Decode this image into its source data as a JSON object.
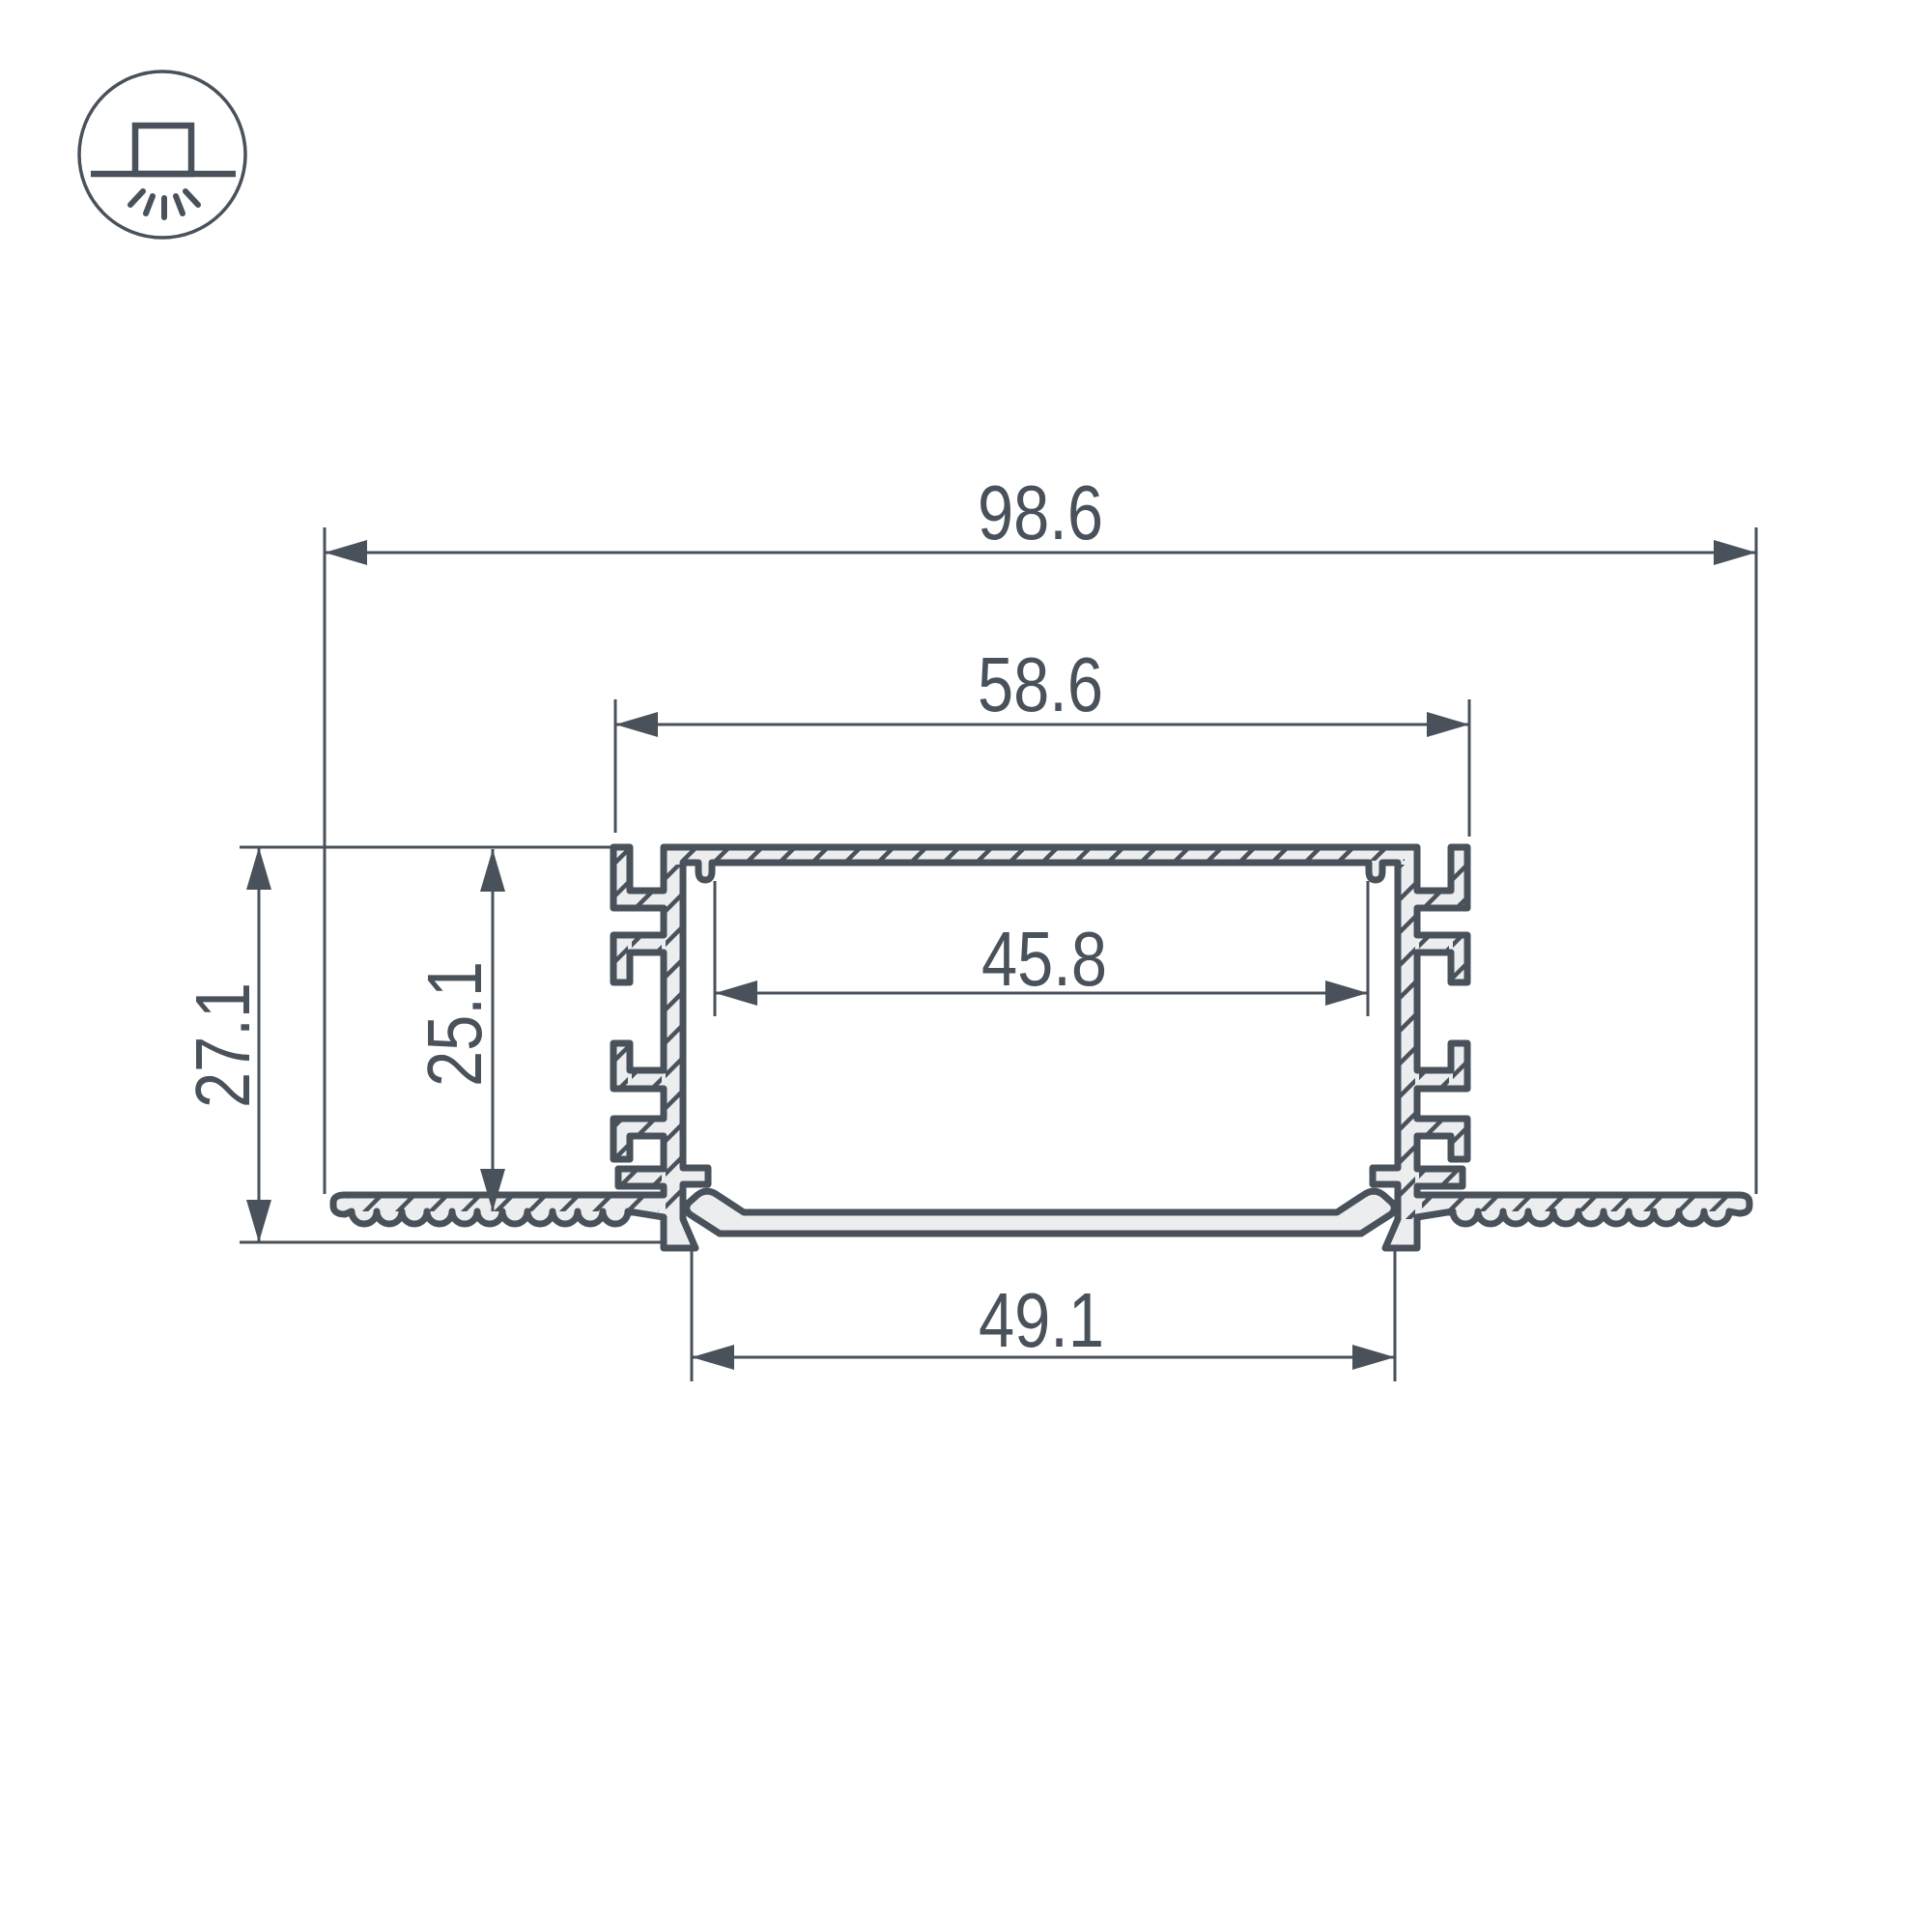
{
  "drawing": {
    "type": "led-profile-cross-section",
    "colors": {
      "line": "#49515A",
      "fill": "#ECEDEE",
      "background": "#FFFFFF"
    },
    "dimensions": {
      "overall_width": "98.6",
      "recess_width": "58.6",
      "window_width": "45.8",
      "cover_width": "49.1",
      "overall_height": "27.1",
      "inner_depth": "25.1"
    },
    "icon": {
      "type": "recessed-downlight-symbol"
    }
  }
}
